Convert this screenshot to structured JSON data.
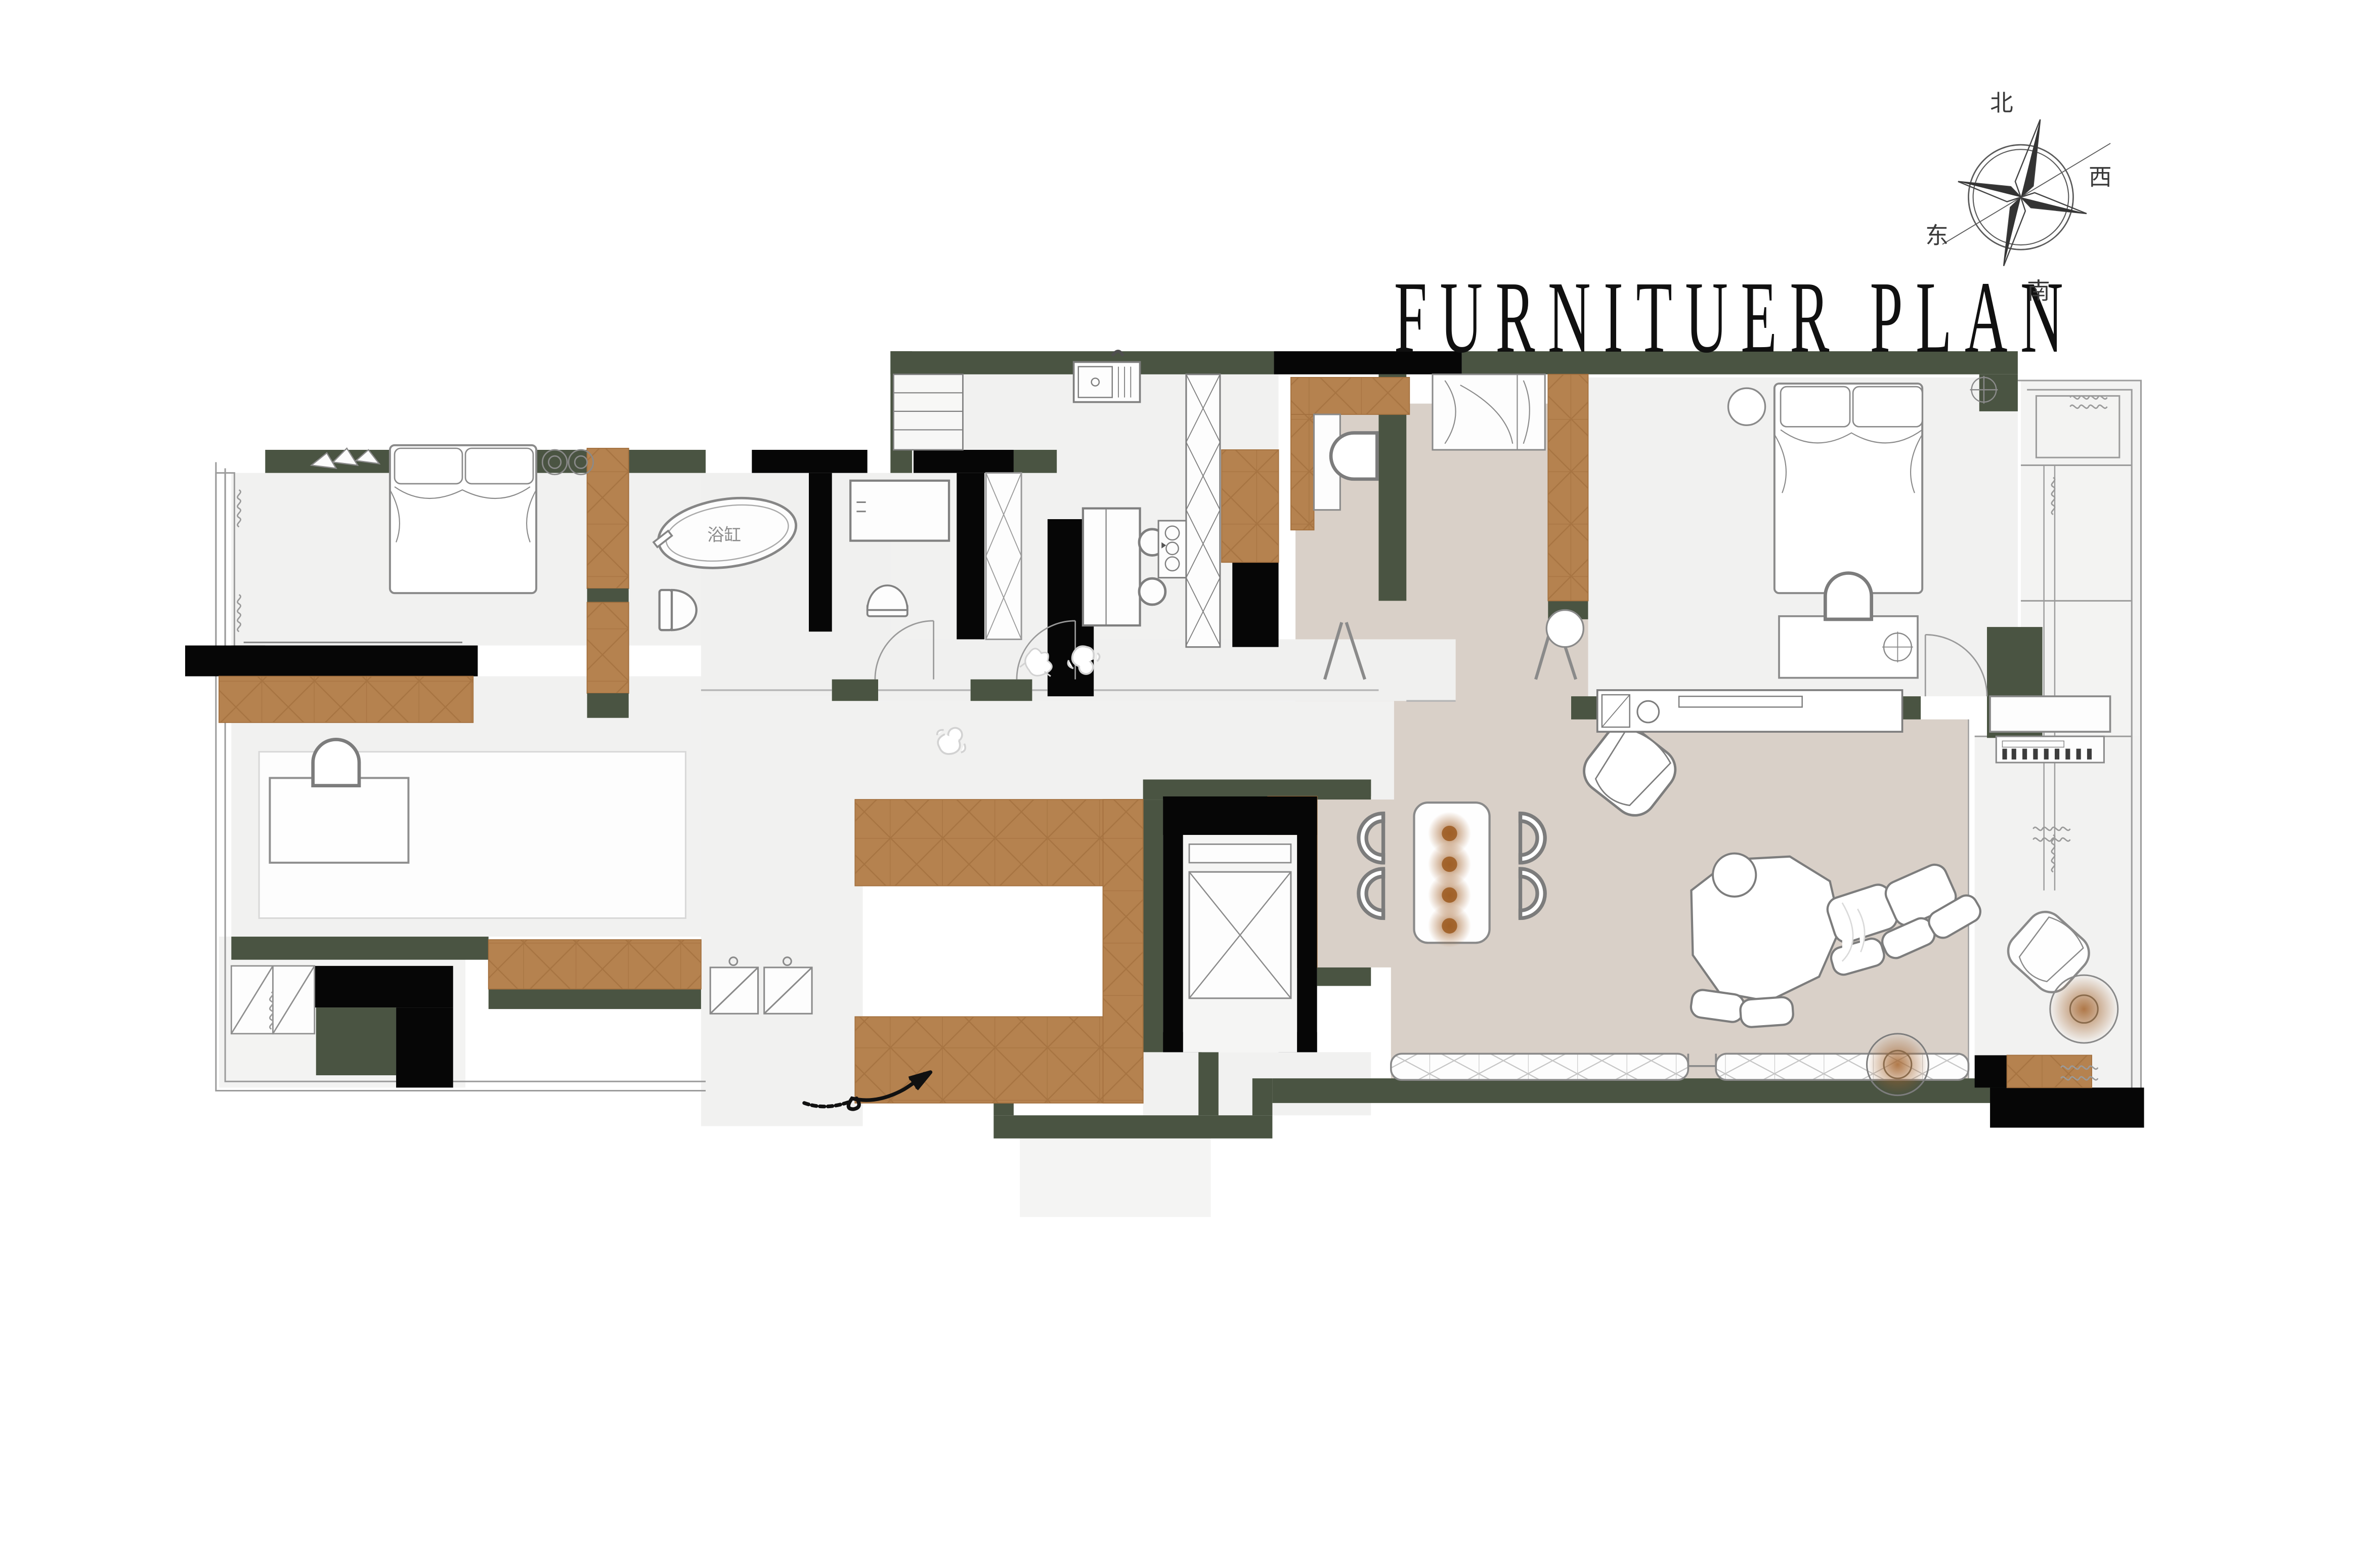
{
  "title": "FURNITUER PLAN",
  "compass": {
    "north": "北",
    "south": "南",
    "east": "东",
    "west": "西"
  },
  "labels": {
    "bathtub": "浴缸"
  },
  "colors": {
    "wall_green": "#4a5442",
    "wall_black": "#060606",
    "wood_cabinet": "#b5824f",
    "wood_seam": "#a4713f",
    "floor_beige": "#d9d0c8",
    "floor_gray": "#f1f1f0",
    "outline_gray": "#8f8f8f",
    "glow_brown": "#a3622a",
    "background": "#ffffff"
  }
}
